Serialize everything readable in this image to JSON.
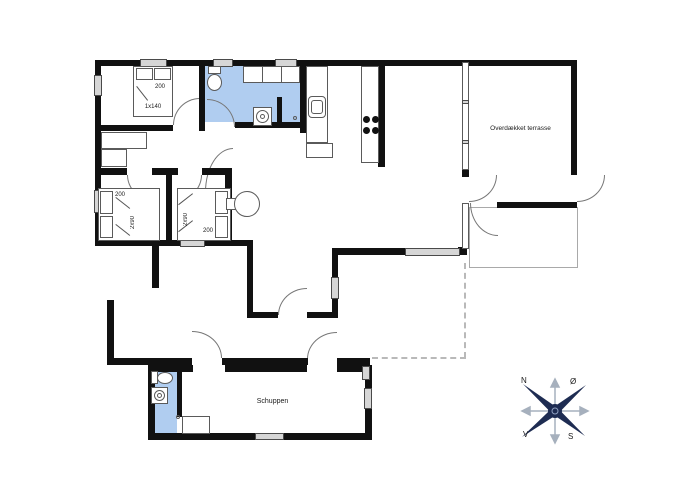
{
  "plan": {
    "terrace_label": "Overdækket terrasse",
    "shed_label": "Schuppen"
  },
  "beds": {
    "bed1": {
      "len": "200",
      "size": "1x140"
    },
    "bed2": {
      "len": "200",
      "size": "2x90"
    },
    "bed3": {
      "len": "200",
      "size": "2x90"
    }
  },
  "compass": {
    "n": "N",
    "e": "Ø",
    "s": "S",
    "w": "V"
  },
  "colors": {
    "wall": "#111111",
    "wet_room": "#b0cdf0",
    "window": "#d6d6d6",
    "compass_navy": "#1e2c52"
  }
}
